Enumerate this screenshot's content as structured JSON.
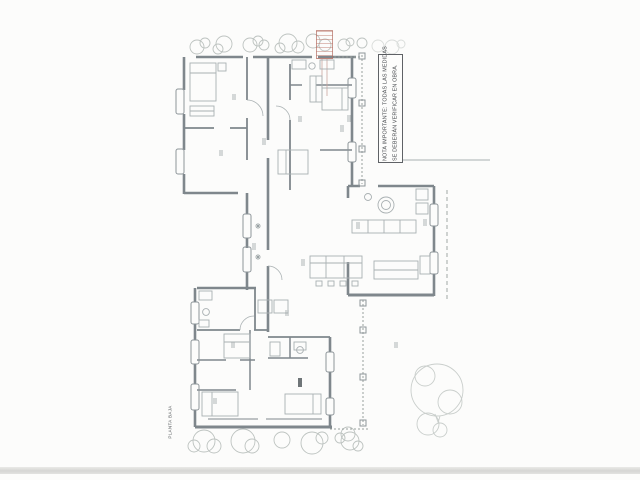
{
  "page": {
    "background": "#fcfcfb",
    "scan_band_color": "#d4d4d2"
  },
  "note": {
    "line1": "NOTA IMPORTANTE: TODAS LAS MEDIDAS",
    "line2": "SE DEBERÁN VERIFICAR EN OBRA."
  },
  "caption": {
    "text": "PLANTA BAJA"
  },
  "stamp": {
    "border_color": "#b2695d",
    "text_color": "#c17f73",
    "note": "illegible red approval stamp"
  },
  "drawing": {
    "wall_color": "#7f878c",
    "line_color": "#8e969a",
    "furniture_color": "#a9b0b2",
    "tree_color": "#bdc3c0",
    "dotted_color": "#98a09d",
    "mark_color": "#9aa2a4",
    "accent_dark": "#6f7578"
  }
}
